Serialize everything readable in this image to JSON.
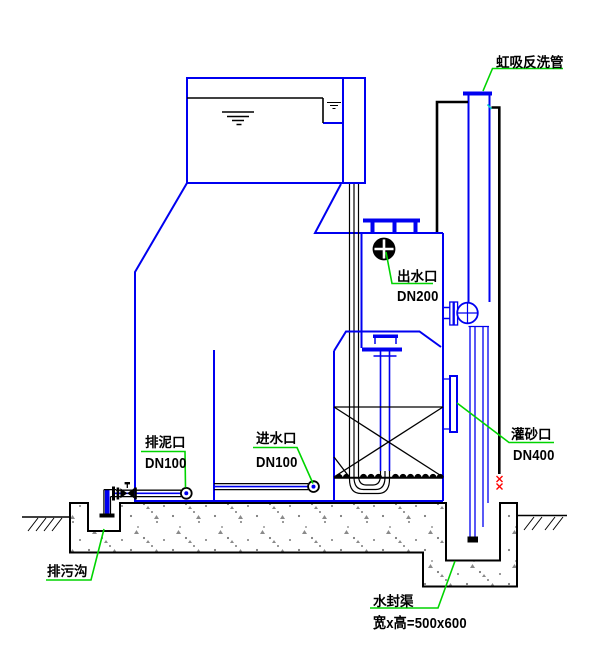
{
  "drawing": {
    "type": "section-drawing",
    "subject": "valveless gravity filter with water seal channel"
  },
  "labels": {
    "siphon": {
      "text": "虹吸反洗管"
    },
    "outlet": {
      "name": "出水口",
      "size": "DN200"
    },
    "mud": {
      "name": "排泥口",
      "size": "DN100"
    },
    "inlet": {
      "name": "进水口",
      "size": "DN100"
    },
    "sand": {
      "name": "灌砂口",
      "size": "DN400"
    },
    "seal": {
      "name": "水封渠",
      "size": "宽x高=500x600"
    },
    "ditch": {
      "name": "排污沟"
    }
  },
  "colors": {
    "line_blue": "#0000f0",
    "line_black": "#000000",
    "leader_green": "#00d400",
    "mark_red": "#ff0000",
    "mark_cyan": "#00c8c8",
    "concrete_stipple": "#7a7a7a"
  }
}
